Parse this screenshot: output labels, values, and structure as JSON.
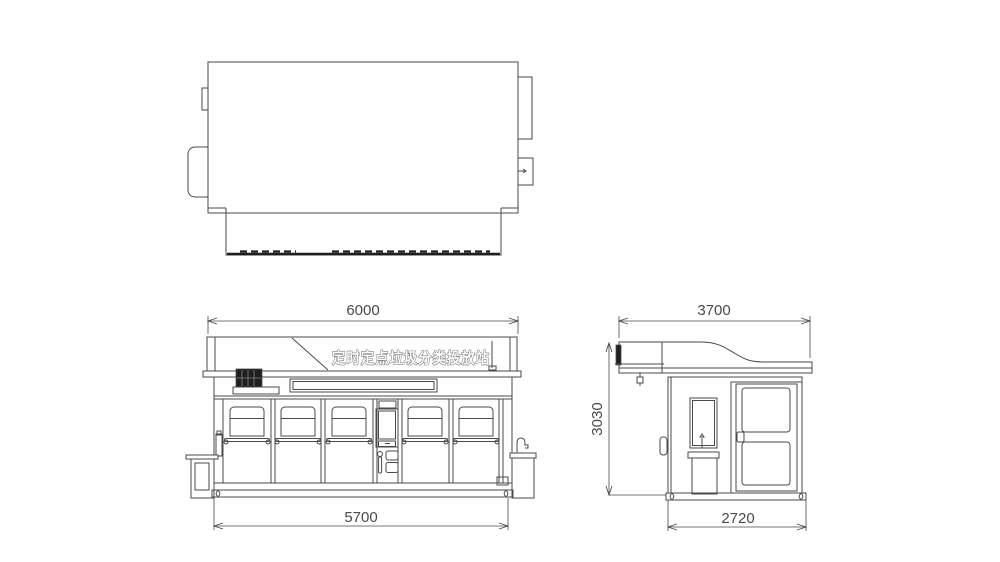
{
  "drawing": {
    "banner_text": "定时定点垃圾分类投放站",
    "dimensions": {
      "front_roof_width": "6000",
      "front_base_width": "5700",
      "side_roof_depth": "3700",
      "side_base_depth": "2720",
      "side_height": "3030"
    }
  },
  "colors": {
    "line": "#4a4a4a",
    "dark": "#1f1f1f",
    "bg": "#ffffff",
    "banner_text_stroke": "#555555"
  }
}
